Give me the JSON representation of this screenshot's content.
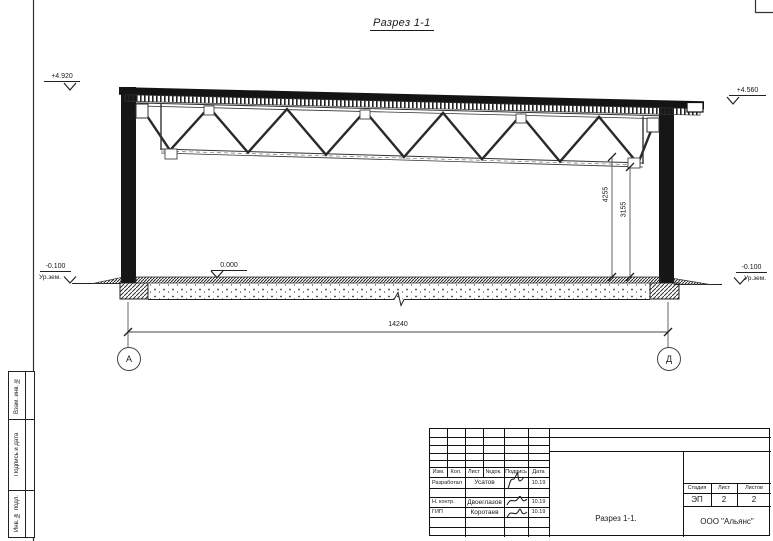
{
  "page": {
    "title": "Разрез 1-1"
  },
  "colors": {
    "ink": "#1a1a1a",
    "paper": "#ffffff"
  },
  "drawing": {
    "elevations": {
      "left_top": "+4.920",
      "right_top": "+4.560",
      "floor": "0.000",
      "left_ground": "-0.100",
      "right_ground": "-0.100",
      "ground_label_left": "Ур.зем.",
      "ground_label_right": "Ур.зем."
    },
    "dimensions": {
      "span": "14240",
      "truss_height": "4255",
      "clear_height": "3155"
    },
    "axes": {
      "left": "А",
      "right": "Д"
    }
  },
  "sidebar": {
    "items": [
      {
        "label": "Взам. инв. №"
      },
      {
        "label": "Подпись и дата"
      },
      {
        "label": "Инв. № подл."
      }
    ]
  },
  "titleblock": {
    "headers": {
      "izm": "Изм.",
      "kol": "Кол.",
      "list": "Лист",
      "ndok": "№док.",
      "podpis": "Подпись",
      "data": "Дата"
    },
    "rows": [
      {
        "role": "Разработал",
        "name": "Усатов",
        "date": "10.19"
      },
      {
        "role": "Н. контр.",
        "name": "Двоеглазов",
        "date": "10.19"
      },
      {
        "role": "ГИП",
        "name": "Коротаев",
        "date": "10.19"
      }
    ],
    "stage": {
      "stadiya_label": "Стадия",
      "list_label": "Лист",
      "listov_label": "Листов",
      "stadiya": "ЭП",
      "list": "2",
      "listov": "2"
    },
    "doc_title": "Разрез 1-1.",
    "company": "ООО \"Альянс\""
  }
}
